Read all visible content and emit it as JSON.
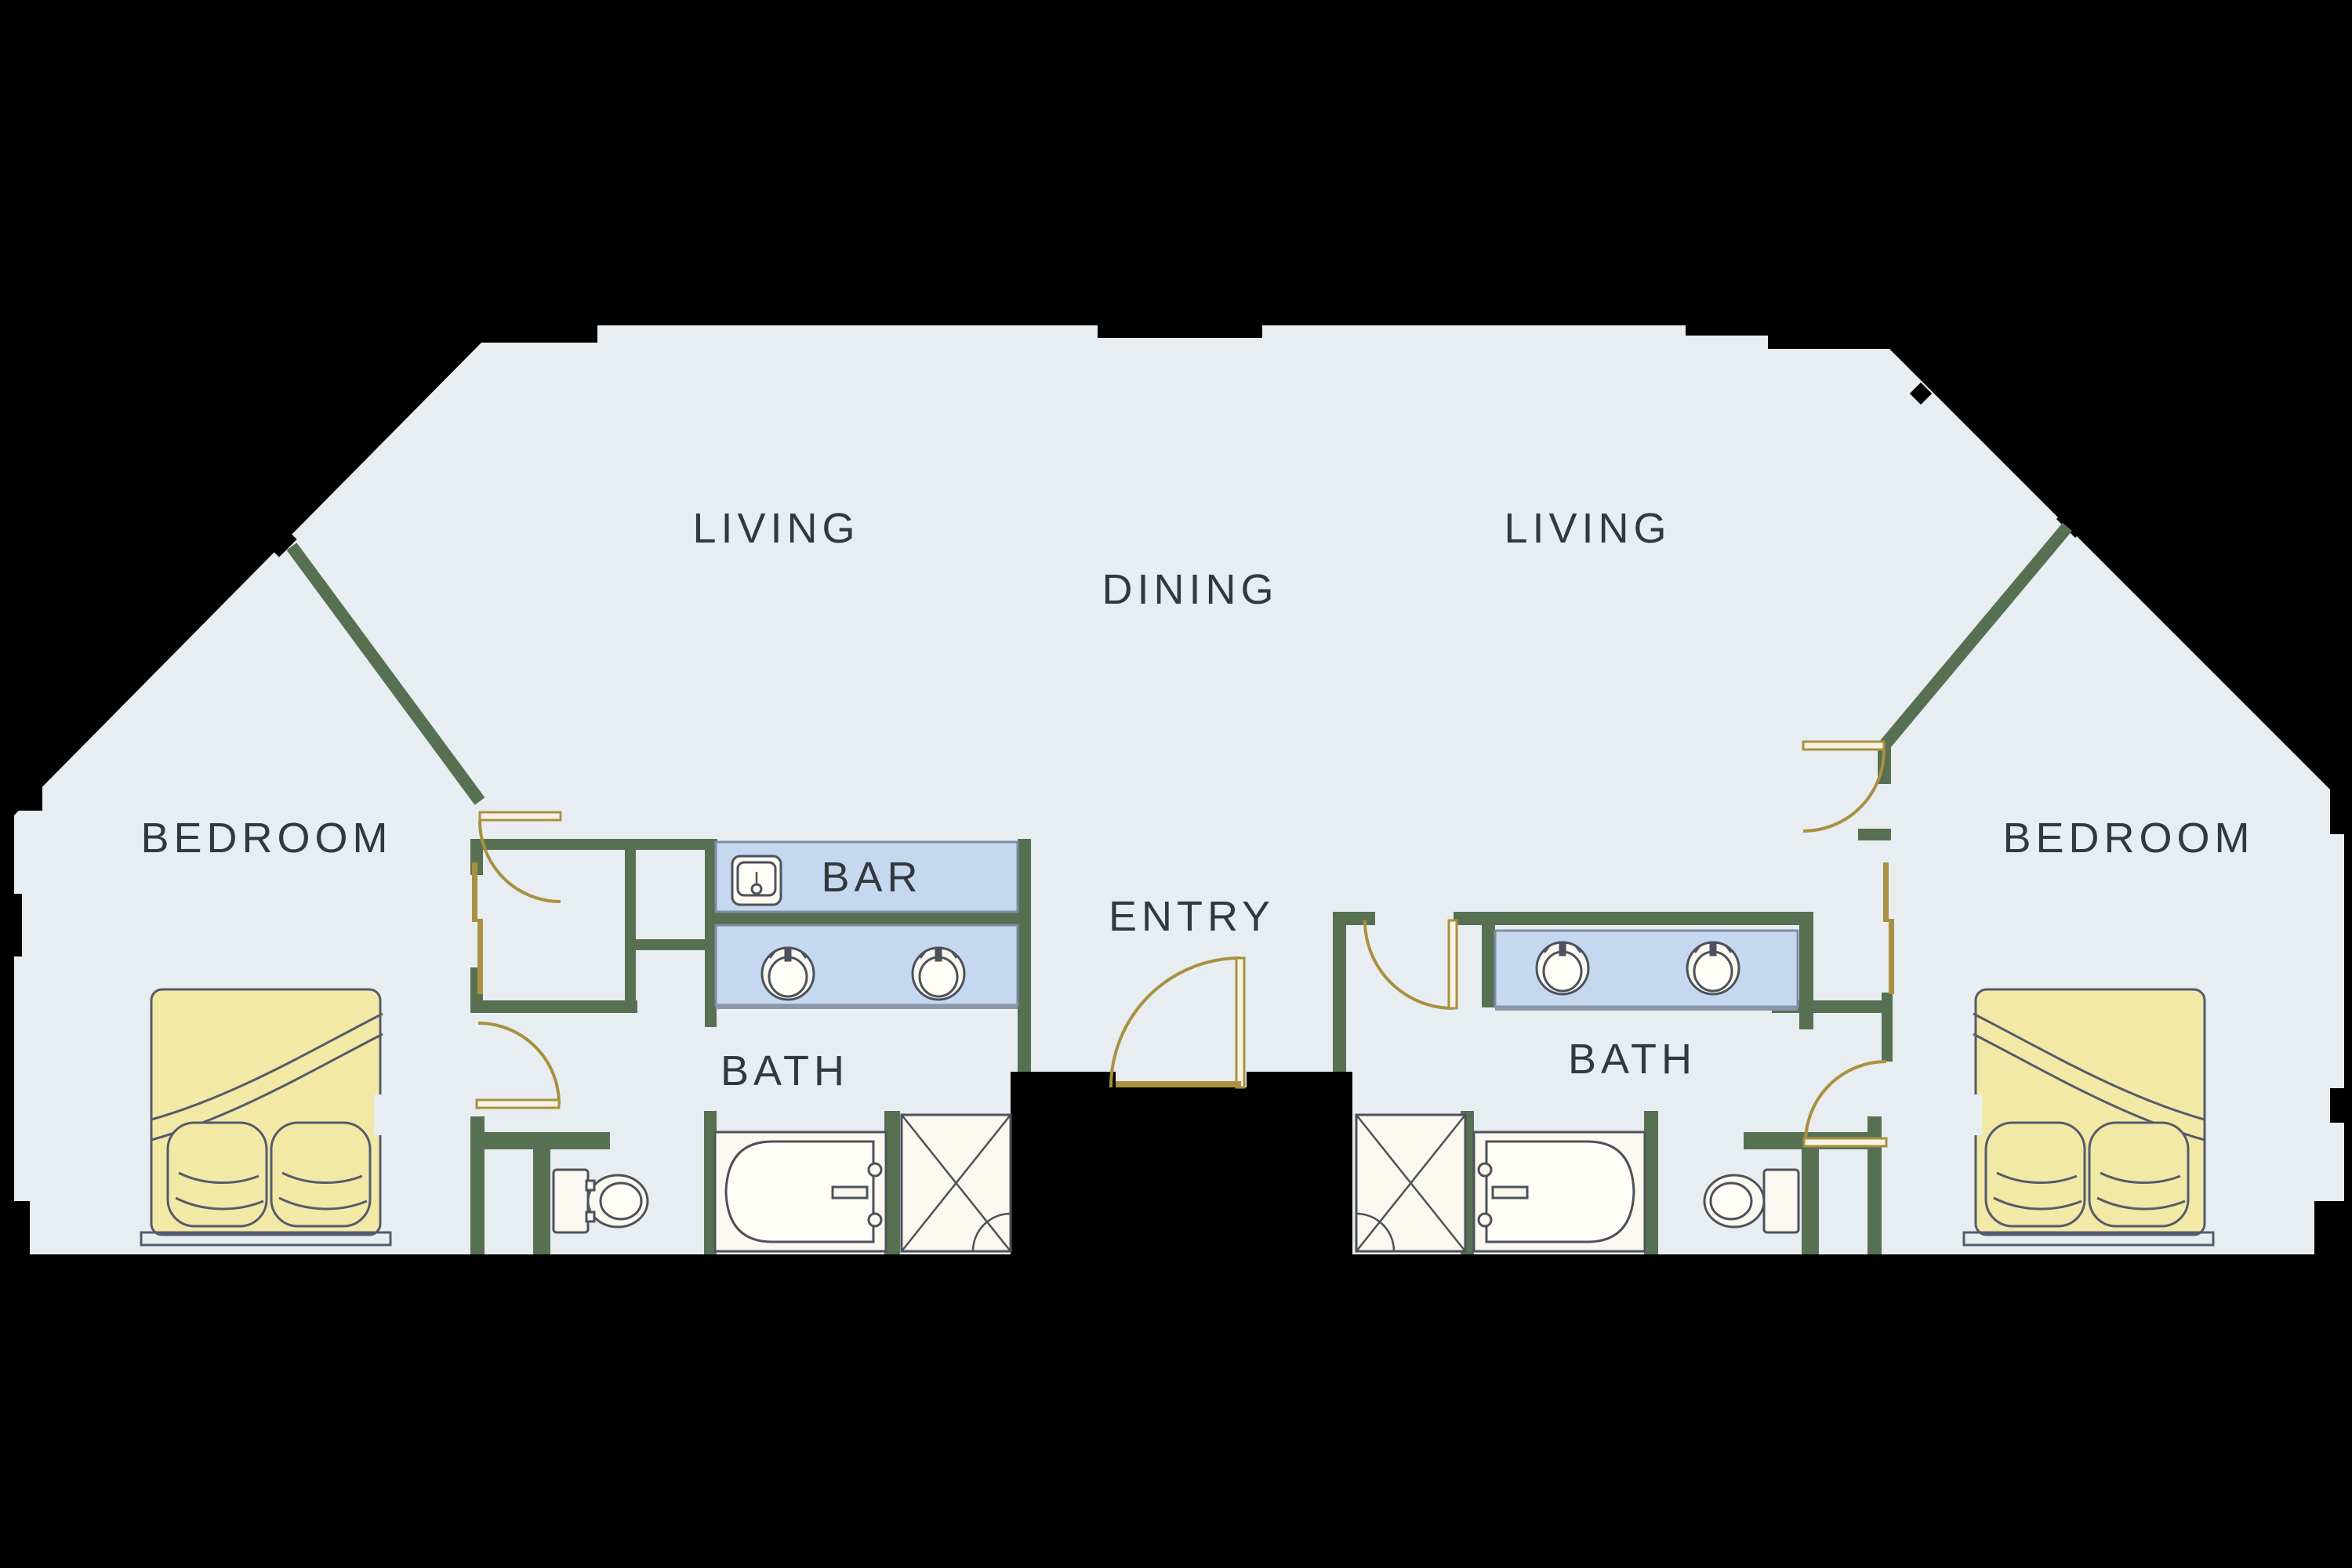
{
  "plan": {
    "labels": {
      "living_left": "LIVING",
      "dining": "DINING",
      "living_right": "LIVING",
      "bedroom_left": "BEDROOM",
      "bedroom_right": "BEDROOM",
      "bar": "BAR",
      "bath_left": "BATH",
      "bath_right": "BATH",
      "entry": "ENTRY"
    },
    "colors": {
      "background": "#000000",
      "floor": "#e7edf1",
      "wall": "#587052",
      "counter": "#c5d8f0",
      "bed": "#f2e9a6",
      "fixture": "#faf8ef",
      "door": "#a8913f",
      "outline": "#4c525c",
      "text": "#33383c"
    },
    "symbols": {
      "beds": 2,
      "bathtubs": 2,
      "showers": 2,
      "toilets": 2,
      "vanity_sinks": 4,
      "bar_sinks": 1,
      "door_swings": 6,
      "sliding_closet_doors": 2
    }
  }
}
